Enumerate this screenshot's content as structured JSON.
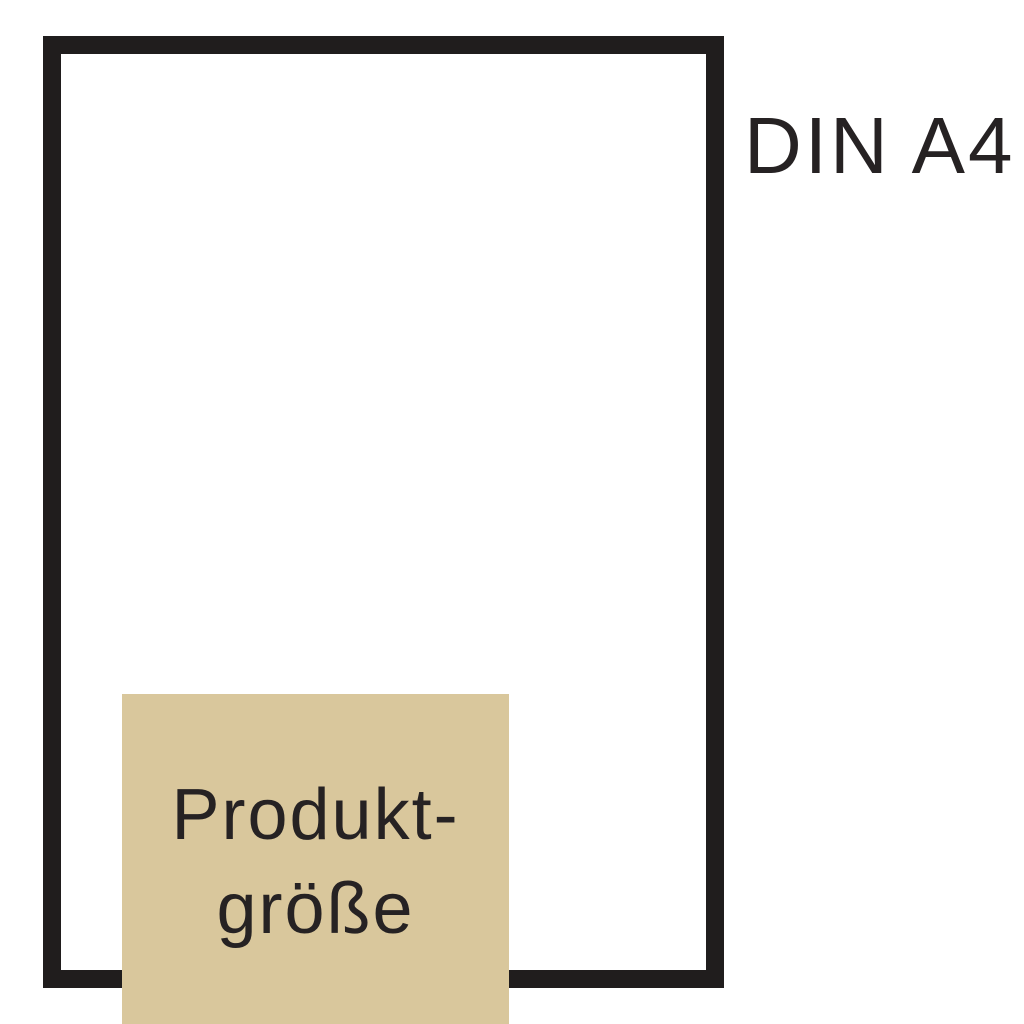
{
  "diagram": {
    "description": "DIN A4 size comparison diagram",
    "page_label": "DIN A4",
    "product_label": {
      "line1": "Produkt-",
      "line2": "größe"
    },
    "colors": {
      "background": "#ffffff",
      "outline": "#201d1d",
      "product_fill": "#d9c79c",
      "text": "#262223"
    }
  }
}
